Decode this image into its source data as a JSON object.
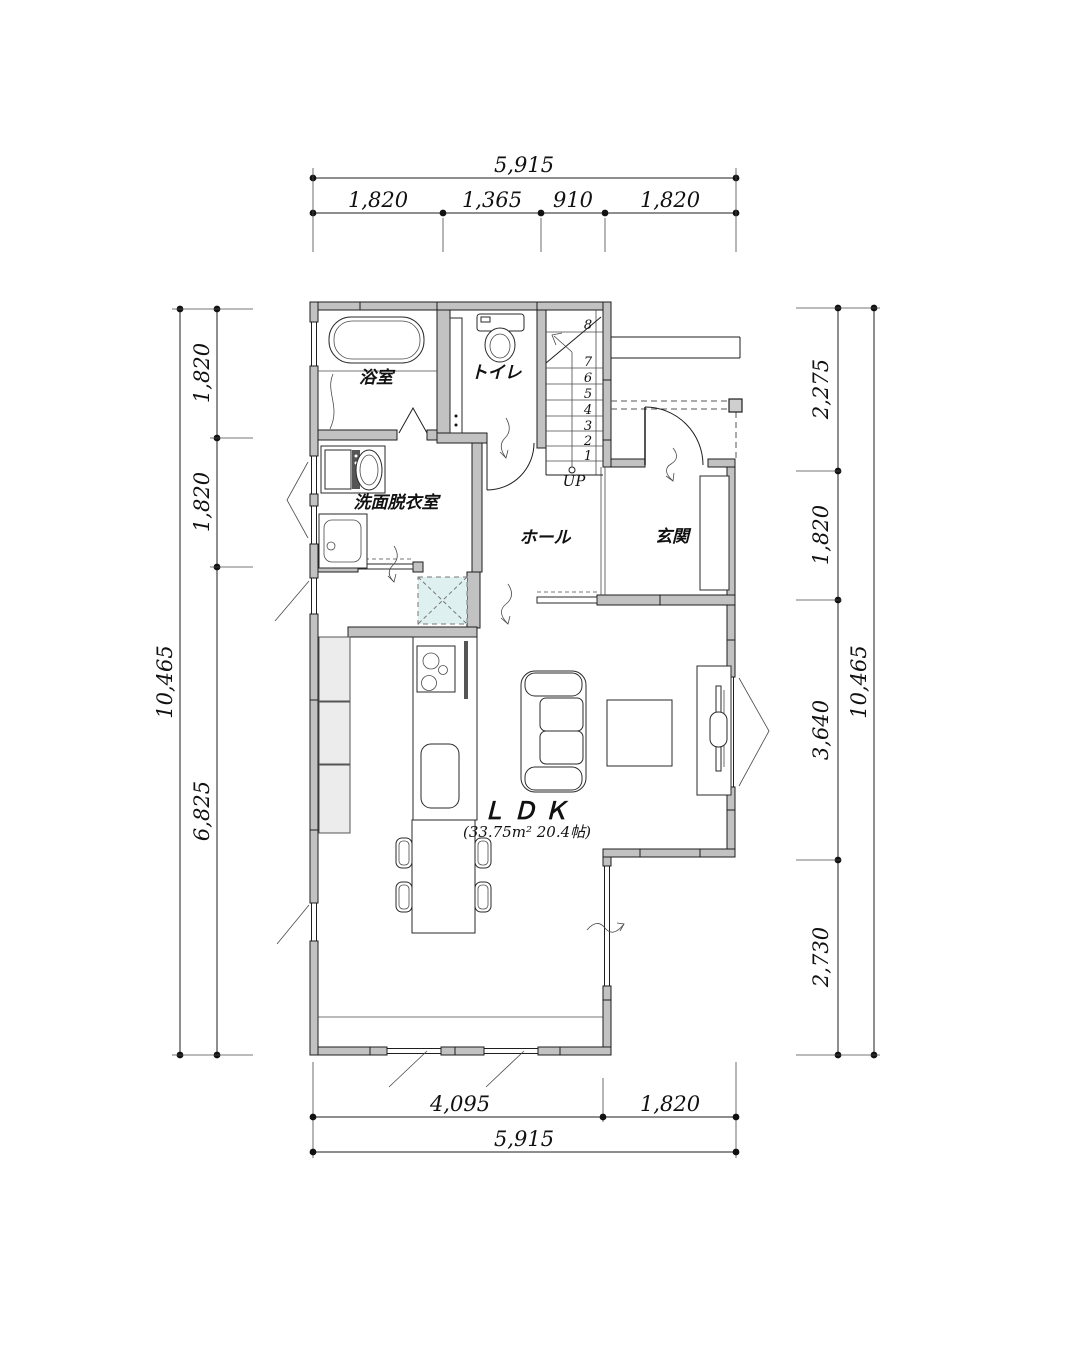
{
  "rooms": {
    "bathroom": {
      "label": "浴室"
    },
    "toilet": {
      "label": "トイレ"
    },
    "washroom": {
      "label": "洗面脱衣室"
    },
    "hall": {
      "label": "ホール"
    },
    "entrance": {
      "label": "玄関"
    },
    "ldk": {
      "label": "ＬＤＫ",
      "area": "(33.75m² 20.4帖)"
    }
  },
  "stairs": {
    "up_label": "UP",
    "step_numbers": [
      "1",
      "2",
      "3",
      "4",
      "5",
      "6",
      "7",
      "8"
    ]
  },
  "dimensions": {
    "top": {
      "total": "5,915",
      "segments": [
        "1,820",
        "1,365",
        "910",
        "1,820"
      ]
    },
    "bottom": {
      "total": "5,915",
      "segments": [
        "4,095",
        "1,820"
      ]
    },
    "left": {
      "total": "10,465",
      "segments": [
        "1,820",
        "1,820",
        "6,825"
      ]
    },
    "right": {
      "total": "10,465",
      "segments": [
        "2,275",
        "1,820",
        "3,640",
        "2,730"
      ]
    }
  },
  "colors": {
    "wall_fill": "#c2c2c2",
    "fixture_fill": "#ececec",
    "highlight_fill": "#def0f0",
    "line": "#1e1e1e"
  }
}
